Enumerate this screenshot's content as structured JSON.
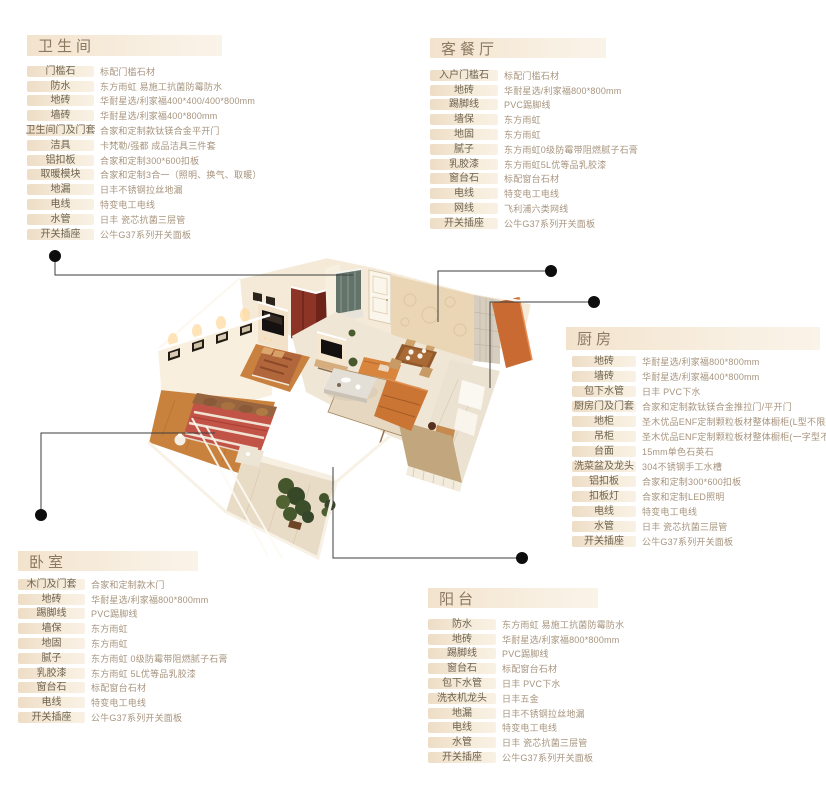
{
  "colors": {
    "dot": "#0d0d0d",
    "connector_line": "#3d3d3d",
    "panel_header_bg": "#f5e7d4",
    "panel_pill_bg": "#f0e0cb",
    "header_text": "#8b7962",
    "label_text": "#6e6250",
    "value_text": "#a7947e",
    "wood_floor": "#c9823d",
    "sofa_orange": "#cb7534",
    "wardrobe_red": "#8c3425",
    "bed_red": "#c15447",
    "plant_green": "#45562d"
  },
  "panels": [
    {
      "id": "bathroom",
      "title": "卫生间",
      "rows": [
        {
          "label": "门槛石",
          "value": "标配门槛石材"
        },
        {
          "label": "防水",
          "value": "东方雨虹 易施工抗菌防霉防水"
        },
        {
          "label": "地砖",
          "value": "华耐星选/利家福400*400/400*800mm"
        },
        {
          "label": "墙砖",
          "value": "华耐星选/利家福400*800mm"
        },
        {
          "label": "卫生间门及门套",
          "value": "合家和定制款钛镁合金平开门"
        },
        {
          "label": "洁具",
          "value": "卡梵勒/强都 成品洁具三件套"
        },
        {
          "label": "铝扣板",
          "value": "合家和定制300*600扣板"
        },
        {
          "label": "取暖模块",
          "value": "合家和定制3合一（照明、换气、取暖）"
        },
        {
          "label": "地漏",
          "value": "日丰不锈钢拉丝地漏"
        },
        {
          "label": "电线",
          "value": "特变电工电线"
        },
        {
          "label": "水管",
          "value": "日丰 瓷芯抗菌三层管"
        },
        {
          "label": "开关插座",
          "value": "公牛G37系列开关面板"
        }
      ]
    },
    {
      "id": "living-dining",
      "title": "客餐厅",
      "rows": [
        {
          "label": "入户门槛石",
          "value": "标配门槛石材"
        },
        {
          "label": "地砖",
          "value": "华耐星选/利家福800*800mm"
        },
        {
          "label": "踢脚线",
          "value": "PVC踢脚线"
        },
        {
          "label": "墙保",
          "value": "东方雨虹"
        },
        {
          "label": "地固",
          "value": "东方雨虹"
        },
        {
          "label": "腻子",
          "value": "东方雨虹0级防霉带阻燃腻子石膏"
        },
        {
          "label": "乳胶漆",
          "value": "东方雨虹5L优等品乳胶漆"
        },
        {
          "label": "窗台石",
          "value": "标配窗台石材"
        },
        {
          "label": "电线",
          "value": "特变电工电线"
        },
        {
          "label": "网线",
          "value": "飞利浦六类网线"
        },
        {
          "label": "开关插座",
          "value": "公牛G37系列开关面板"
        }
      ]
    },
    {
      "id": "kitchen",
      "title": "厨房",
      "rows": [
        {
          "label": "地砖",
          "value": "华耐星选/利家福800*800mm"
        },
        {
          "label": "墙砖",
          "value": "华耐星选/利家福400*800mm"
        },
        {
          "label": "包下水管",
          "value": "日丰 PVC下水"
        },
        {
          "label": "厨房门及门套",
          "value": "合家和定制款钛镁合金推拉门/平开门"
        },
        {
          "label": "地柜",
          "value": "圣木优品ENF定制颗粒板材整体橱柜(L型不限延米)"
        },
        {
          "label": "吊柜",
          "value": "圣木优品ENF定制颗粒板材整体橱柜(一字型不限延米)"
        },
        {
          "label": "台面",
          "value": "15mm单色石英石"
        },
        {
          "label": "洗菜盆及龙头",
          "value": "304不锈钢手工水槽"
        },
        {
          "label": "铝扣板",
          "value": "合家和定制300*600扣板"
        },
        {
          "label": "扣板灯",
          "value": "合家和定制LED照明"
        },
        {
          "label": "电线",
          "value": "特变电工电线"
        },
        {
          "label": "水管",
          "value": "日丰 瓷芯抗菌三层管"
        },
        {
          "label": "开关插座",
          "value": "公牛G37系列开关面板"
        }
      ]
    },
    {
      "id": "bedroom",
      "title": "卧室",
      "rows": [
        {
          "label": "木门及门套",
          "value": "合家和定制款木门"
        },
        {
          "label": "地砖",
          "value": "华耐星选/利家福800*800mm"
        },
        {
          "label": "踢脚线",
          "value": "PVC踢脚线"
        },
        {
          "label": "墙保",
          "value": "东方雨虹"
        },
        {
          "label": "地固",
          "value": "东方雨虹"
        },
        {
          "label": "腻子",
          "value": "东方雨虹 0级防霉带阻燃腻子石膏"
        },
        {
          "label": "乳胶漆",
          "value": "东方雨虹 5L优等品乳胶漆"
        },
        {
          "label": "窗台石",
          "value": "标配窗台石材"
        },
        {
          "label": "电线",
          "value": "特变电工电线"
        },
        {
          "label": "开关插座",
          "value": "公牛G37系列开关面板"
        }
      ]
    },
    {
      "id": "balcony",
      "title": "阳台",
      "rows": [
        {
          "label": "防水",
          "value": "东方雨虹 易施工抗菌防霉防水"
        },
        {
          "label": "地砖",
          "value": "华耐星选/利家福800*800mm"
        },
        {
          "label": "踢脚线",
          "value": "PVC踢脚线"
        },
        {
          "label": "窗台石",
          "value": "标配窗台石材"
        },
        {
          "label": "包下水管",
          "value": "日丰 PVC下水"
        },
        {
          "label": "洗衣机龙头",
          "value": "日丰五金"
        },
        {
          "label": "地漏",
          "value": "日丰不锈钢拉丝地漏"
        },
        {
          "label": "电线",
          "value": "特变电工电线"
        },
        {
          "label": "水管",
          "value": "日丰 瓷芯抗菌三层管"
        },
        {
          "label": "开关插座",
          "value": "公牛G37系列开关面板"
        }
      ]
    }
  ]
}
